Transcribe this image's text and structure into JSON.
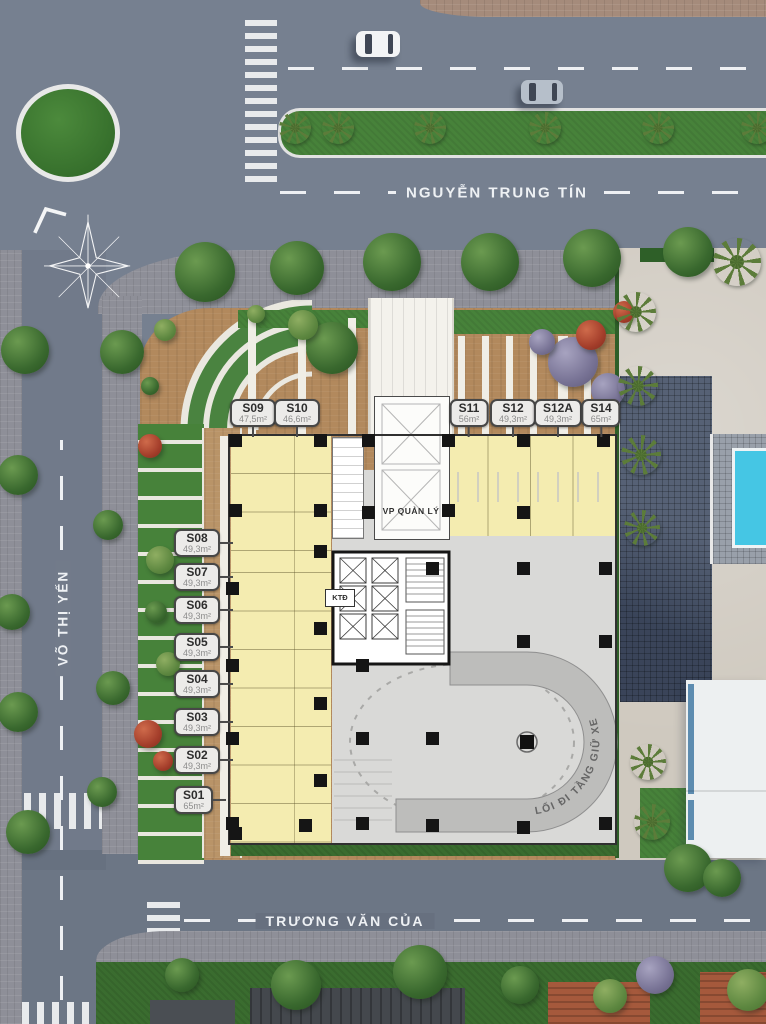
{
  "streets": {
    "top": "NGUYỄN TRUNG TÍN",
    "left": "VÕ THỊ YẾN",
    "bottom": "TRƯƠNG VĂN CỦA"
  },
  "site": {
    "management_office": "VP QUẢN LÝ",
    "technical_room": "KTĐ",
    "parking_ramp": "LỐI ĐI TẦNG GIỮ XE"
  },
  "units_top": [
    {
      "id": "S09",
      "area": "47,5m²"
    },
    {
      "id": "S10",
      "area": "46,6m²"
    },
    {
      "id": "S11",
      "area": "56m²"
    },
    {
      "id": "S12",
      "area": "49,3m²"
    },
    {
      "id": "S12A",
      "area": "49,3m²"
    },
    {
      "id": "S14",
      "area": "65m²"
    }
  ],
  "units_left": [
    {
      "id": "S08",
      "area": "49,3m²"
    },
    {
      "id": "S07",
      "area": "49,3m²"
    },
    {
      "id": "S06",
      "area": "49,3m²"
    },
    {
      "id": "S05",
      "area": "49,3m²"
    },
    {
      "id": "S04",
      "area": "49,3m²"
    },
    {
      "id": "S03",
      "area": "49,3m²"
    },
    {
      "id": "S02",
      "area": "49,3m²"
    },
    {
      "id": "S01",
      "area": "65m²"
    }
  ],
  "colors": {
    "road": "#768090",
    "sidewalk": "#8e8f98",
    "site_paving": "#b2895d",
    "unit_fill": "#f4ecb0",
    "parking_floor": "#d9d9d7",
    "ramp": "#bdbdbb",
    "grass": "#47823a",
    "pool": "#45c6e4",
    "label_bg": "#ecebe9"
  }
}
